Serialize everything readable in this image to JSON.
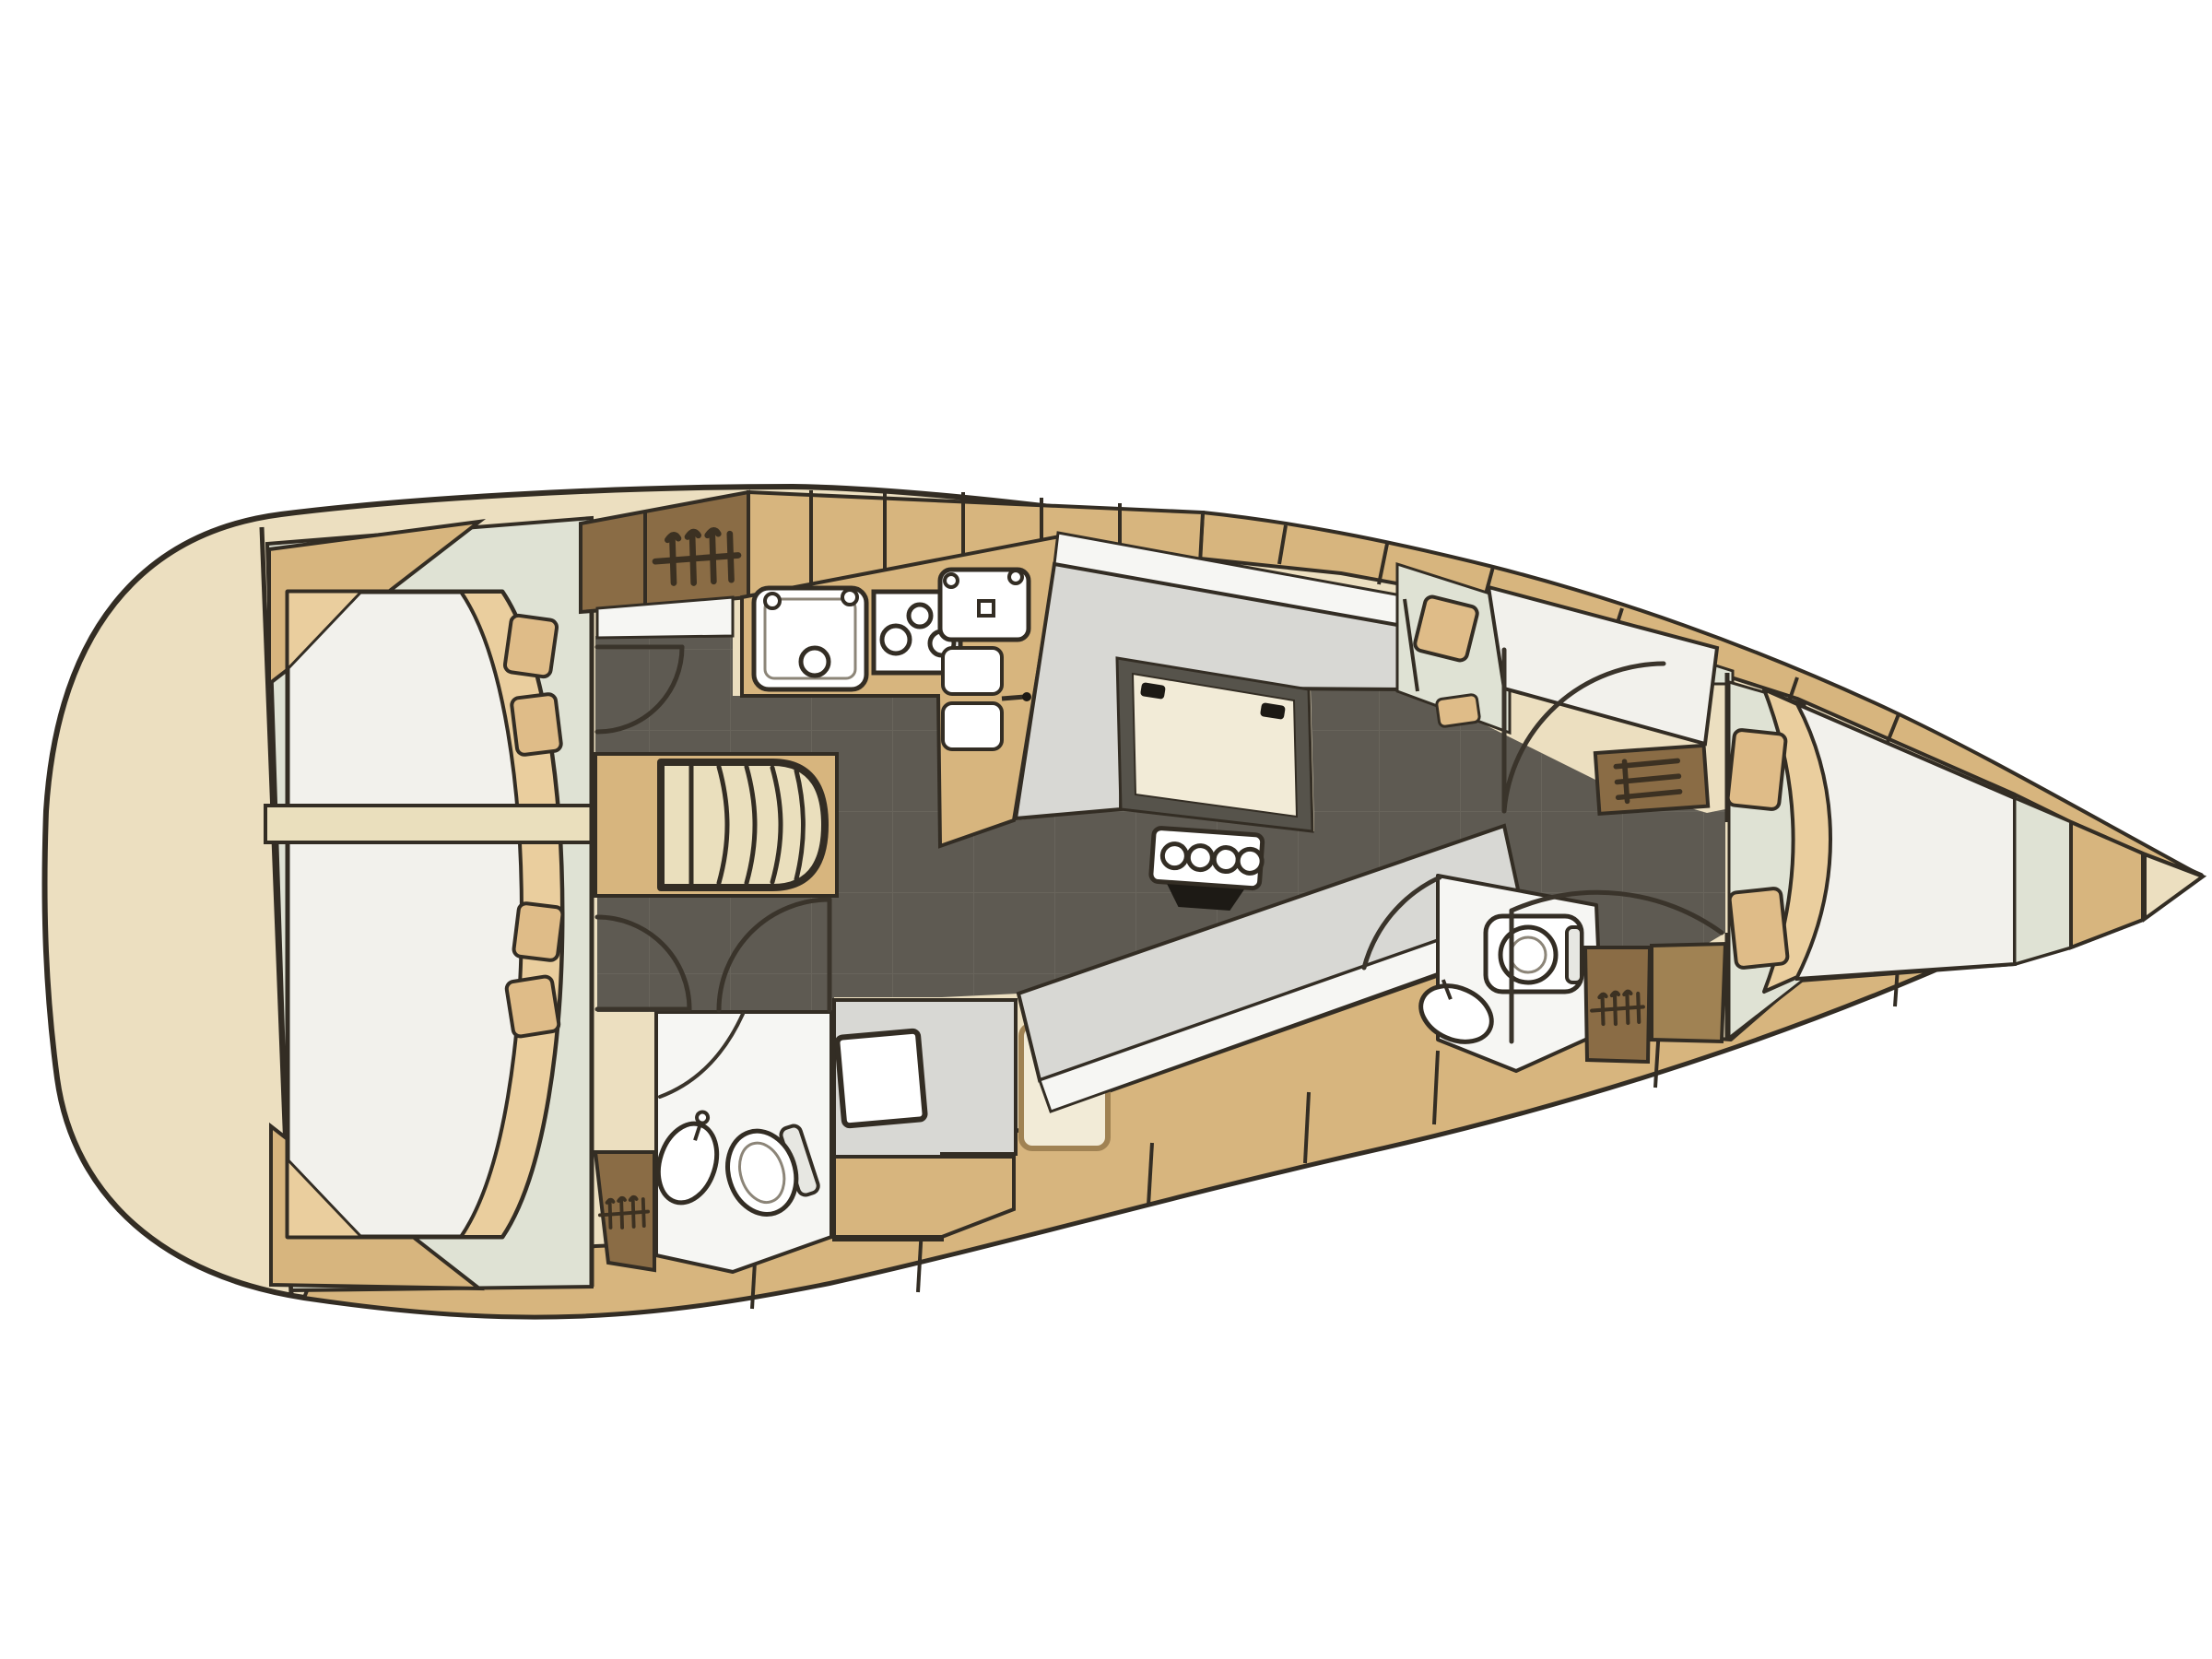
{
  "diagram": {
    "type": "sailboat-interior-floor-plan",
    "view": "top-down",
    "orientation": "bow-right-stern-left",
    "background": "white",
    "text_labels": []
  },
  "palette": {
    "page_bg": "#ffffff",
    "outline": "#332d24",
    "soft_line": "#8c8578",
    "door_line": "#3a342b",
    "hull_cream": "#ecdfc0",
    "deck_tan": "#d7b57e",
    "locker_brown": "#8a6c45",
    "locker_brown_light": "#a08253",
    "icon_dark": "#3c3122",
    "floor_dark": "#5e5a52",
    "floor_grid": "#716c62",
    "cabin_green": "#dfe2d4",
    "settee_gray": "#d8d8d4",
    "strip_white": "#f6f6f3",
    "bed_white": "#f2f1ec",
    "blanket_tan": "#eace9e",
    "pillow_tan": "#dfbc88",
    "table_border": "#56534b",
    "table_cream": "#f2ebd7",
    "fixture_white": "#ffffff",
    "fixture_shadow": "#e7e7e2",
    "cream_bar": "#eadfbd",
    "black": "#1d1a15"
  },
  "components": {
    "hull": [
      "hull-outline",
      "stern-deck",
      "side-deck-top",
      "side-deck-bottom",
      "anchor-locker"
    ],
    "aft_cabin": [
      "cabin-floor",
      "double-berth",
      "blanket",
      "pillows-x4",
      "mast-beam"
    ],
    "midship": [
      "hanging-locker",
      "galley-cabinets",
      "galley-sink-double",
      "galley-stove-3-burner",
      "galley-sink",
      "fridge-two-lids",
      "companionway-stairs",
      "engine-box"
    ],
    "salon": [
      "u-settee",
      "saloon-table",
      "table-clips",
      "bottle-holder-4",
      "bottom-settee",
      "seat-cushion",
      "nav-seat",
      "chart-table",
      "nav-desk"
    ],
    "aft_head": [
      "toilet",
      "washbasin",
      "shower-door"
    ],
    "guest_cabin": [
      "single-berth",
      "pillow",
      "stool-cushion",
      "shelf-unit"
    ],
    "fore_head": [
      "toilet",
      "washbasin",
      "hanging-locker",
      "locker-panel"
    ],
    "fore_cabin": [
      "v-berth",
      "blanket",
      "pillows-x2",
      "berth-frame"
    ],
    "doors": [
      "aft-cabin-door-top",
      "aft-cabin-door-bottom",
      "aft-head-door",
      "guest-cabin-door",
      "fore-cabin-door",
      "fore-head-door"
    ]
  },
  "icons": [
    "hanger-icon",
    "hanger-icon",
    "hanger-icon",
    "shelves-icon",
    "faucet-icon",
    "drain-icon",
    "stove-burner-icon"
  ]
}
